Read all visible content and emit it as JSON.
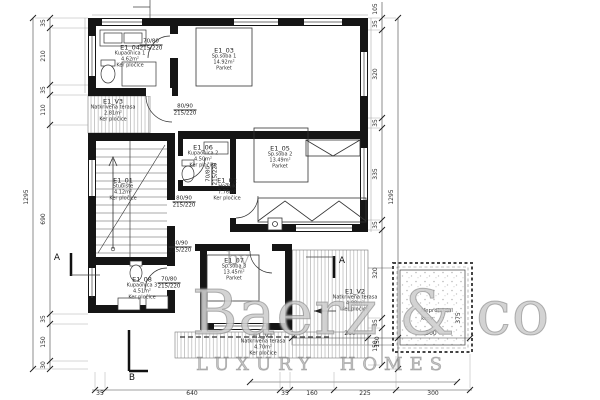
{
  "watermark": {
    "by": "by",
    "brand": "Baerz & co",
    "tagline": "LUXURY HOMES"
  },
  "rooms": [
    {
      "id": "E1_04",
      "name": "Kupaonica 1",
      "area": "4.62m²",
      "floor": "Ker pločice"
    },
    {
      "id": "E1_03",
      "name": "Sp.soba 1",
      "area": "14.92m²",
      "floor": "Parket"
    },
    {
      "id": "E1_V3",
      "name": "Natkrivena terasa",
      "area": "2.81m²",
      "floor": "Ker pločice"
    },
    {
      "id": "E1_01",
      "name": "Stubište",
      "area": "4.12m²",
      "floor": "Ker pločice"
    },
    {
      "id": "E1_02",
      "name": "Hodnik",
      "area": "7.76m²",
      "floor": "Ker pločice"
    },
    {
      "id": "E1_06",
      "name": "Kupaonica 2",
      "area": "4.50m²",
      "floor": "Ker pločice"
    },
    {
      "id": "E1_05",
      "name": "Sp.soba 2",
      "area": "13.49m²",
      "floor": "Parket"
    },
    {
      "id": "E1_08",
      "name": "Kupaonica 3",
      "area": "4.51m²",
      "floor": "Ker pločice"
    },
    {
      "id": "E1_07",
      "name": "Sp.soba 3",
      "area": "13.45m²",
      "floor": "Parket"
    },
    {
      "id": "E1_V2",
      "name": "Natkrivena terasa",
      "area": "4.98m²",
      "floor": "Ker pločice"
    },
    {
      "id": "E1_V1",
      "name": "Natkrivena terasa",
      "area": "4.70m²",
      "floor": "Ker pločice"
    }
  ],
  "roof": {
    "line1": "Neprohodni",
    "line2": "krov"
  },
  "doors": [
    {
      "w": "70/80",
      "h": "215/220"
    },
    {
      "w": "80/90",
      "h": "215/220"
    },
    {
      "w": "80/90",
      "h": "215/220"
    },
    {
      "w": "70/80",
      "h": "215/220"
    },
    {
      "w": "80/90",
      "h": "215/220"
    },
    {
      "w": "70/80",
      "h": "215/220"
    }
  ],
  "dimensions": {
    "left_chain": [
      "35",
      "210",
      "35",
      "110",
      "690",
      "35",
      "150",
      "30"
    ],
    "left_overall": "1295",
    "right_chain": [
      "105",
      "35",
      "320",
      "35",
      "335",
      "35",
      "320",
      "35",
      "150"
    ],
    "right_overall": "1295",
    "bottom_chain": [
      "35",
      "640",
      "35",
      "160",
      "225",
      "300"
    ],
    "mid_chain": [
      "260",
      "150",
      "300"
    ],
    "roof_height": "375"
  },
  "sections": {
    "a": "A",
    "b": "B"
  }
}
